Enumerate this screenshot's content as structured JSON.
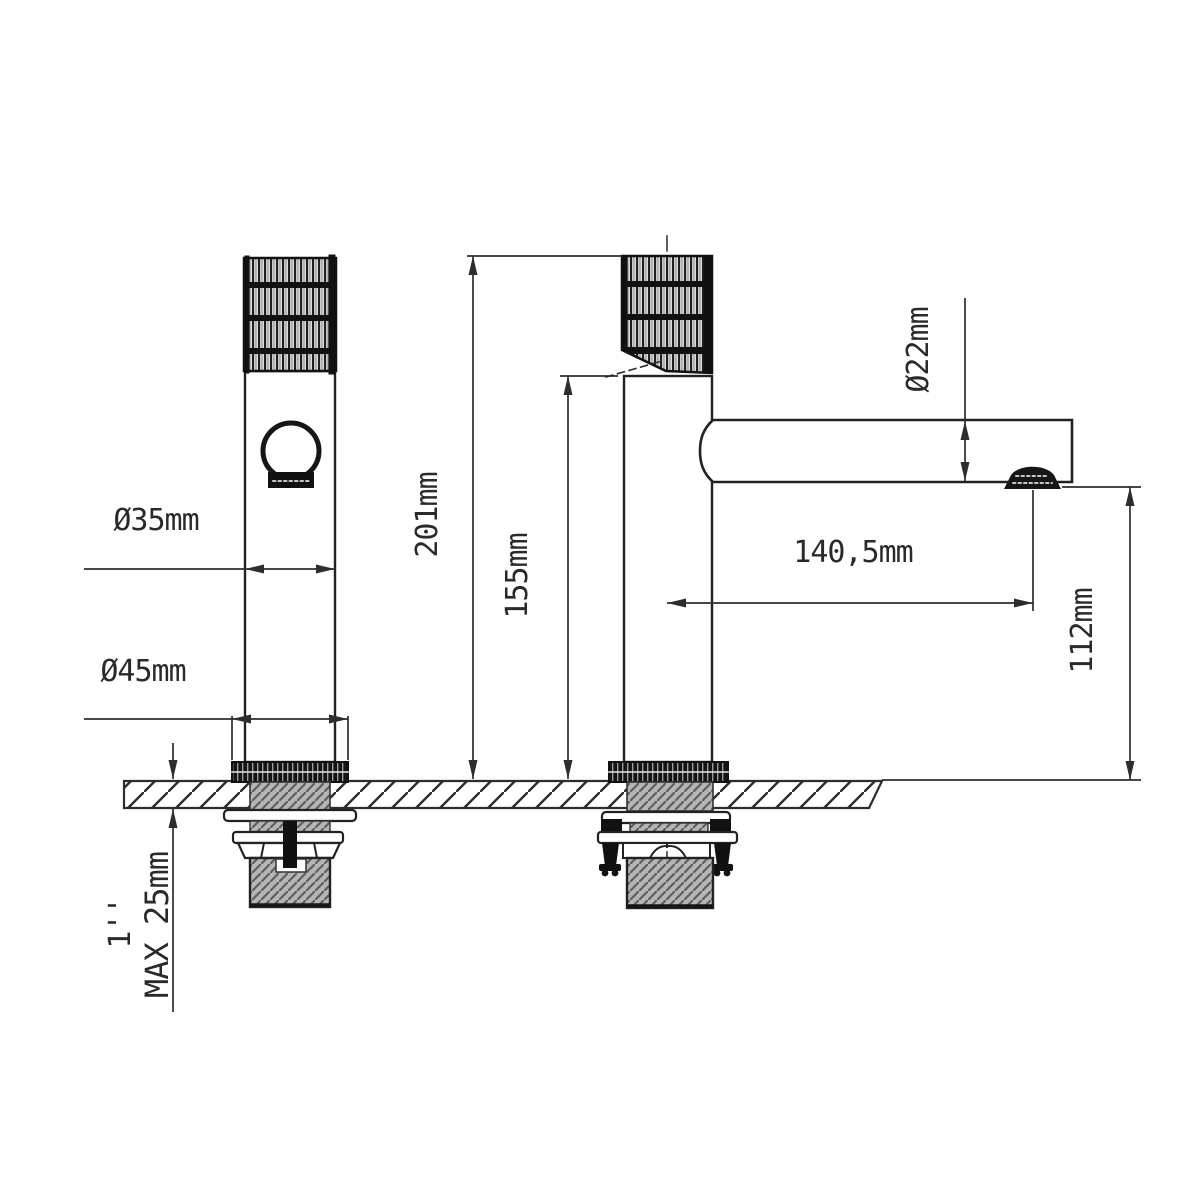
{
  "drawing": {
    "type": "technical-dimension-drawing",
    "subject": "basin mixer tap, front and side views with installation dimensions",
    "colors": {
      "background": "#ffffff",
      "line": "#2d2d2d",
      "dark_fill": "#161616",
      "grey_hatch": "#bdbdbd"
    },
    "labels": {
      "handle_diameter": "Ø35mm",
      "base_diameter": "Ø45mm",
      "total_height": "201mm",
      "spout_top_height": "155mm",
      "spout_diameter": "Ø22mm",
      "spout_reach": "140,5mm",
      "spout_clearance": "112mm",
      "thread_size": "1''",
      "max_counter_thickness": "MAX 25mm"
    }
  }
}
